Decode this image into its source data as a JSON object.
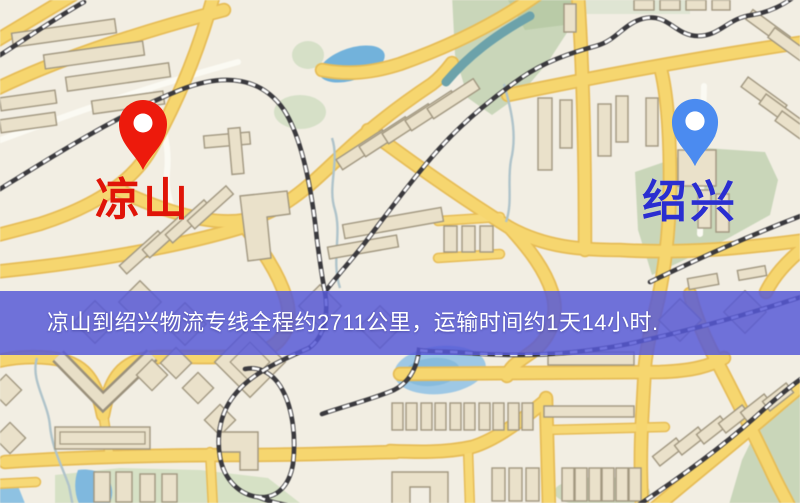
{
  "page": {
    "kind": "logistics-route-map-image"
  },
  "banner": {
    "text": "凉山到绍兴物流专线全程约2711公里，运输时间约1天14小时.",
    "origin": "凉山",
    "destination": "绍兴",
    "distance_text": "约2711公里",
    "duration_text": "约1天14小时",
    "bg_color": "#5658d7",
    "text_color": "#ffffff"
  },
  "markers": {
    "origin": {
      "label": "凉山",
      "pin_color": "#ed1a0c",
      "label_color": "#e01408"
    },
    "destination": {
      "label": "绍兴",
      "pin_color": "#4b8bf0",
      "label_color": "#2a2ed0"
    }
  },
  "map_palette": {
    "background": "#f2eee3",
    "road_fill": "#f7d66b",
    "road_casing": "#e8bc52",
    "park": "#c9d6b8",
    "water": "#70b2dd",
    "building": "#eae1c9",
    "railway": "#3a393d"
  }
}
